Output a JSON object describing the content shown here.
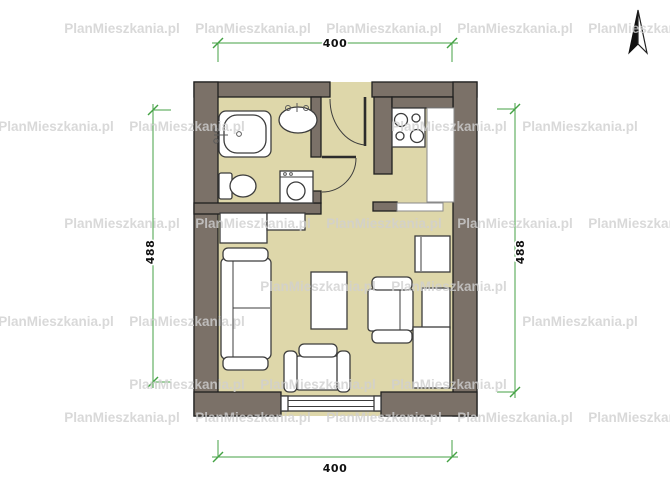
{
  "site": {
    "watermark_text": "PlanMieszkania.pl"
  },
  "dimensions": {
    "top": "400",
    "bottom": "400",
    "left": "488",
    "right": "488"
  },
  "colors": {
    "wall": "#7b7168",
    "floor": "#ded7aa",
    "outline": "#1f1f1f",
    "furniture": "#ffffff",
    "dimension_green": "#44a244",
    "watermark": "#d0d0d0"
  },
  "compass": {
    "icon": "north-arrow"
  },
  "plan": {
    "rooms": [
      {
        "name": "bathroom",
        "fixtures": [
          "bathtub",
          "washbasin",
          "toilet",
          "washing-machine"
        ]
      },
      {
        "name": "hall",
        "fixtures": [
          "entrance-door",
          "bathroom-door"
        ]
      },
      {
        "name": "kitchen",
        "fixtures": [
          "cooktop-4-burner",
          "countertop",
          "pass-shelf"
        ]
      },
      {
        "name": "living-room",
        "fixtures": [
          "sofa",
          "coffee-table",
          "armchair-side",
          "armchair-front",
          "cabinet",
          "cabinet",
          "sideboard",
          "wardrobe",
          "window"
        ]
      }
    ]
  }
}
